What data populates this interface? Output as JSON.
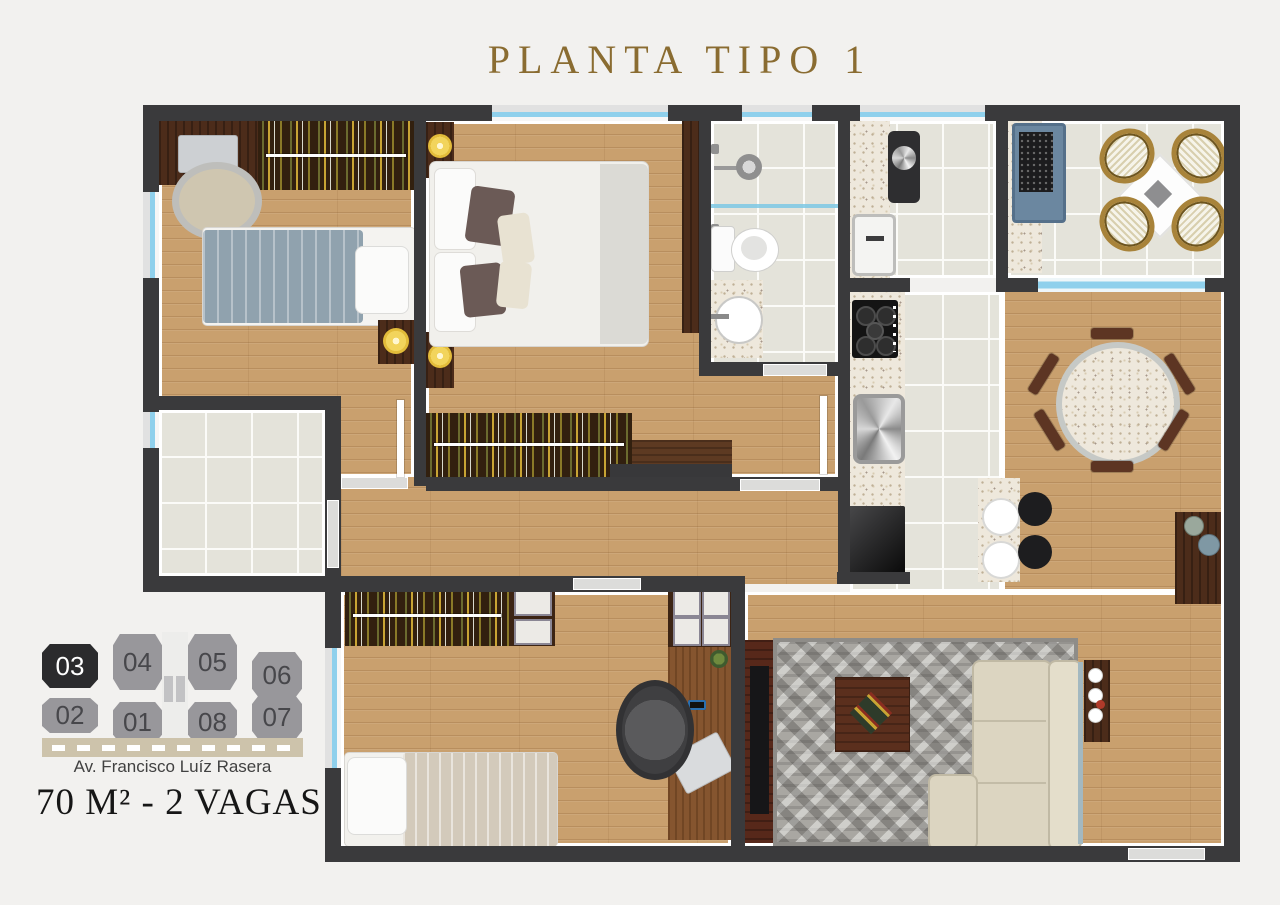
{
  "title": "PLANTA TIPO 1",
  "keyplan": {
    "units": [
      {
        "label": "03",
        "highlighted": true
      },
      {
        "label": "04",
        "highlighted": false
      },
      {
        "label": "05",
        "highlighted": false
      },
      {
        "label": "06",
        "highlighted": false
      },
      {
        "label": "02",
        "highlighted": false
      },
      {
        "label": "01",
        "highlighted": false
      },
      {
        "label": "08",
        "highlighted": false
      },
      {
        "label": "07",
        "highlighted": false
      }
    ],
    "street_label": "Av. Francisco Luíz Rasera"
  },
  "footer": {
    "area_label": "70 M² - 2 VAGAS"
  },
  "colors": {
    "background": "#f2f1ef",
    "title_gold": "#8a6c31",
    "wall": "#3a3a3c",
    "window_glass": "#8fd0ec",
    "wood_floor": "#c9a06e",
    "tile_floor": "#e4e3da",
    "granite": "#eee8dc",
    "highlighted_unit_bg": "#2b2b2d",
    "unit_bg": "#98979b",
    "street_strip": "#cdc3ab"
  }
}
